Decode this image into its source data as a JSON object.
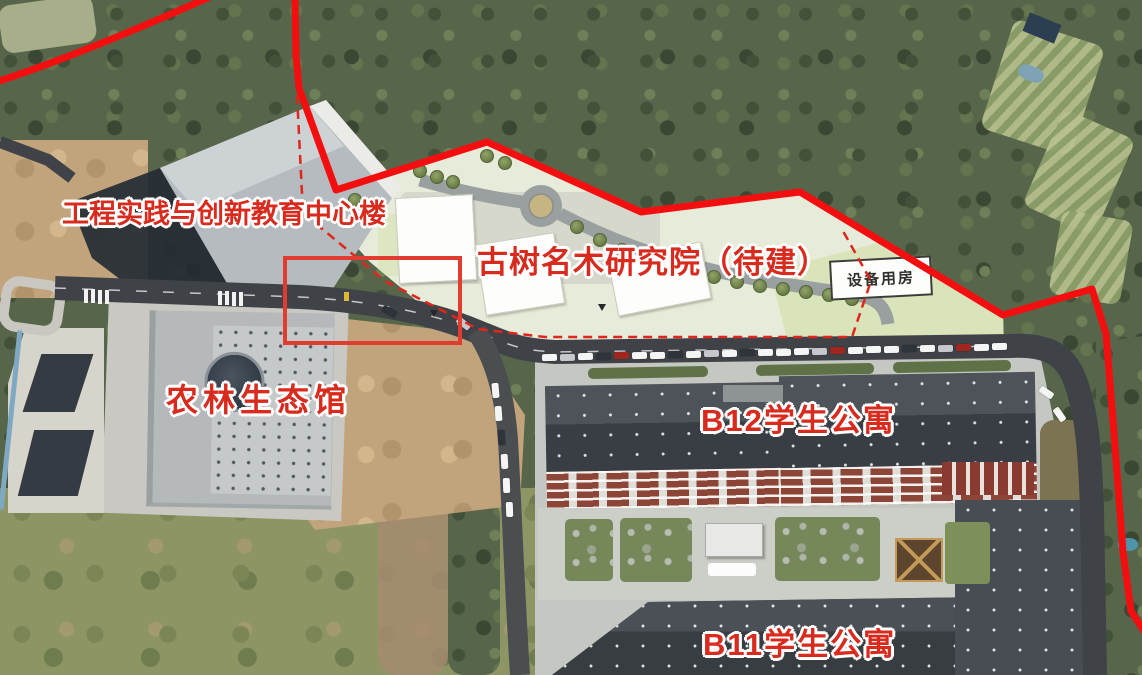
{
  "map_title": "校园航拍总平面标注图",
  "labels": [
    {
      "id": "engineering-center-label",
      "text": "工程实践与创新教育中心楼",
      "x": 62,
      "y": 200,
      "size": 27,
      "spacing": 0
    },
    {
      "id": "ancient-tree-institute-label",
      "text": "古树名木研究院（待建）",
      "x": 477,
      "y": 246,
      "size": 31,
      "spacing": 1
    },
    {
      "id": "agri-forestry-eco-hall-label",
      "text": "农林生态馆",
      "x": 166,
      "y": 383,
      "size": 32,
      "spacing": 5
    },
    {
      "id": "b12-dorm-label",
      "text": "B12学生公寓",
      "x": 701,
      "y": 404,
      "size": 31,
      "spacing": 2
    },
    {
      "id": "b11-dorm-label",
      "text": "B11学生公寓",
      "x": 703,
      "y": 628,
      "size": 31,
      "spacing": 2
    }
  ],
  "plan_box": {
    "id": "equipment-room-label",
    "text": "设备用房",
    "x": 830,
    "y": 258,
    "w": 102,
    "h": 40,
    "rot": -3
  },
  "colors": {
    "boundary_red": "#f30f0f",
    "highlight_red": "#e23c30",
    "label_red": "#d92a1e",
    "label_outline": "#ffffff",
    "plan_area": "#e7ebd9",
    "road_dark": "#3f4347",
    "roof_slate": "#41474c"
  },
  "cars": [
    {
      "x": 549,
      "y": 357,
      "r": -1,
      "c": "#f5f5f5"
    },
    {
      "x": 567,
      "y": 357,
      "r": -1,
      "c": "#c6c9cc"
    },
    {
      "x": 585,
      "y": 356,
      "r": -1,
      "c": "#f5f5f5"
    },
    {
      "x": 603,
      "y": 356,
      "r": -1,
      "c": "#2f343a"
    },
    {
      "x": 621,
      "y": 355,
      "r": -1,
      "c": "#a12620"
    },
    {
      "x": 639,
      "y": 355,
      "r": -1,
      "c": "#f5f5f5"
    },
    {
      "x": 657,
      "y": 355,
      "r": -1,
      "c": "#f5f5f5"
    },
    {
      "x": 675,
      "y": 354,
      "r": -1,
      "c": "#2f343a"
    },
    {
      "x": 693,
      "y": 354,
      "r": -1,
      "c": "#f5f5f5"
    },
    {
      "x": 711,
      "y": 353,
      "r": -1,
      "c": "#c6c9cc"
    },
    {
      "x": 729,
      "y": 353,
      "r": -1,
      "c": "#f5f5f5"
    },
    {
      "x": 747,
      "y": 352,
      "r": -1,
      "c": "#2f343a"
    },
    {
      "x": 765,
      "y": 352,
      "r": -1,
      "c": "#f5f5f5"
    },
    {
      "x": 783,
      "y": 352,
      "r": -1,
      "c": "#f5f5f5"
    },
    {
      "x": 801,
      "y": 351,
      "r": -1,
      "c": "#f5f5f5"
    },
    {
      "x": 819,
      "y": 351,
      "r": -1,
      "c": "#c6c9cc"
    },
    {
      "x": 837,
      "y": 350,
      "r": -1,
      "c": "#a12620"
    },
    {
      "x": 855,
      "y": 350,
      "r": -1,
      "c": "#f5f5f5"
    },
    {
      "x": 873,
      "y": 349,
      "r": -1,
      "c": "#f5f5f5"
    },
    {
      "x": 891,
      "y": 349,
      "r": -1,
      "c": "#f5f5f5"
    },
    {
      "x": 909,
      "y": 348,
      "r": -1,
      "c": "#2f343a"
    },
    {
      "x": 927,
      "y": 348,
      "r": -1,
      "c": "#f5f5f5"
    },
    {
      "x": 945,
      "y": 348,
      "r": -1,
      "c": "#c6c9cc"
    },
    {
      "x": 963,
      "y": 347,
      "r": -1,
      "c": "#a12620"
    },
    {
      "x": 981,
      "y": 347,
      "r": -1,
      "c": "#f5f5f5"
    },
    {
      "x": 999,
      "y": 346,
      "r": -1,
      "c": "#f5f5f5"
    },
    {
      "x": 495,
      "y": 390,
      "r": 85,
      "c": "#f5f5f5"
    },
    {
      "x": 498,
      "y": 413,
      "r": 86,
      "c": "#f5f5f5"
    },
    {
      "x": 501,
      "y": 437,
      "r": 86,
      "c": "#2f343a"
    },
    {
      "x": 504,
      "y": 461,
      "r": 87,
      "c": "#f5f5f5"
    },
    {
      "x": 506,
      "y": 485,
      "r": 88,
      "c": "#f5f5f5"
    },
    {
      "x": 509,
      "y": 509,
      "r": 88,
      "c": "#f5f5f5"
    },
    {
      "x": 1046,
      "y": 392,
      "r": 35,
      "c": "#f5f5f5"
    },
    {
      "x": 1059,
      "y": 414,
      "r": 55,
      "c": "#f5f5f5"
    },
    {
      "x": 389,
      "y": 311,
      "r": 28,
      "c": "#2f343a"
    },
    {
      "x": 463,
      "y": 323,
      "r": 38,
      "c": "#c6c9cc"
    }
  ],
  "plan_trees": [
    {
      "x": 420,
      "y": 171
    },
    {
      "x": 437,
      "y": 177
    },
    {
      "x": 453,
      "y": 182
    },
    {
      "x": 355,
      "y": 200
    },
    {
      "x": 368,
      "y": 215
    },
    {
      "x": 487,
      "y": 156
    },
    {
      "x": 505,
      "y": 163
    },
    {
      "x": 577,
      "y": 227
    },
    {
      "x": 600,
      "y": 240
    },
    {
      "x": 622,
      "y": 250
    },
    {
      "x": 645,
      "y": 259
    },
    {
      "x": 668,
      "y": 266
    },
    {
      "x": 691,
      "y": 272
    },
    {
      "x": 714,
      "y": 277
    },
    {
      "x": 737,
      "y": 282
    },
    {
      "x": 760,
      "y": 286
    },
    {
      "x": 783,
      "y": 289
    },
    {
      "x": 806,
      "y": 292
    },
    {
      "x": 829,
      "y": 295
    },
    {
      "x": 852,
      "y": 299
    }
  ]
}
